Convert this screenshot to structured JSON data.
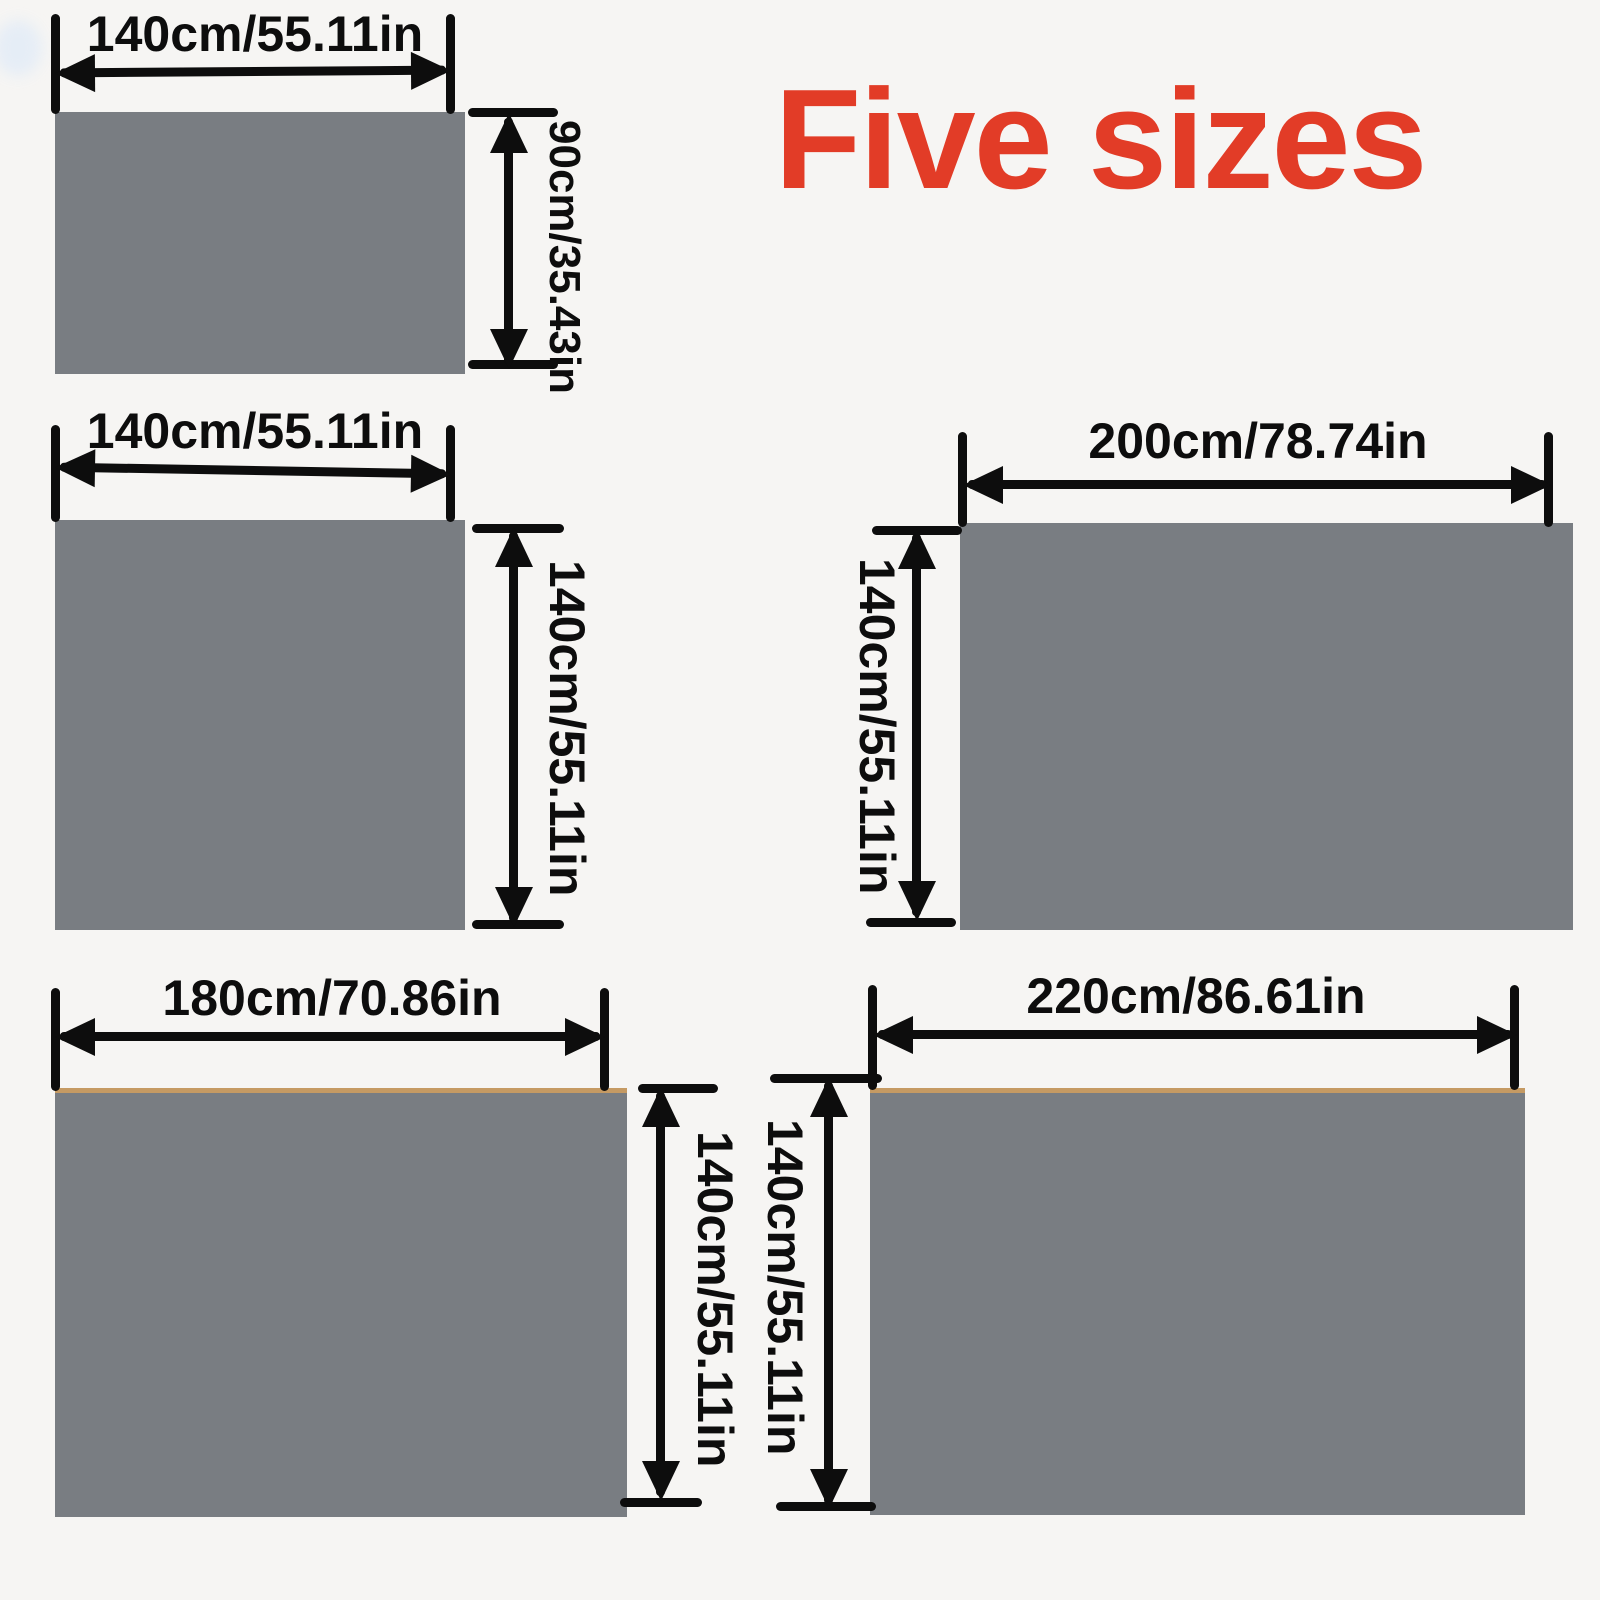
{
  "title": {
    "text": "Five sizes"
  },
  "colors": {
    "accent_red": "#e23c27",
    "swatch_gray": "#797d82",
    "dimension_black": "#0d0d0d",
    "background": "#f6f5f3",
    "trim_tan": "#c59a63"
  },
  "panels": [
    {
      "name": "top-left",
      "width_label": "140cm/55.11in",
      "height_label": "90cm/35.43in"
    },
    {
      "name": "middle-left",
      "width_label": "140cm/55.11in",
      "height_label": "140cm/55.11in"
    },
    {
      "name": "middle-right",
      "width_label": "200cm/78.74in",
      "height_label": "140cm/55.11in"
    },
    {
      "name": "bottom-left",
      "width_label": "180cm/70.86in",
      "height_label": "140cm/55.11in"
    },
    {
      "name": "bottom-right",
      "width_label": "220cm/86.61in",
      "height_label": "140cm/55.11in"
    }
  ]
}
